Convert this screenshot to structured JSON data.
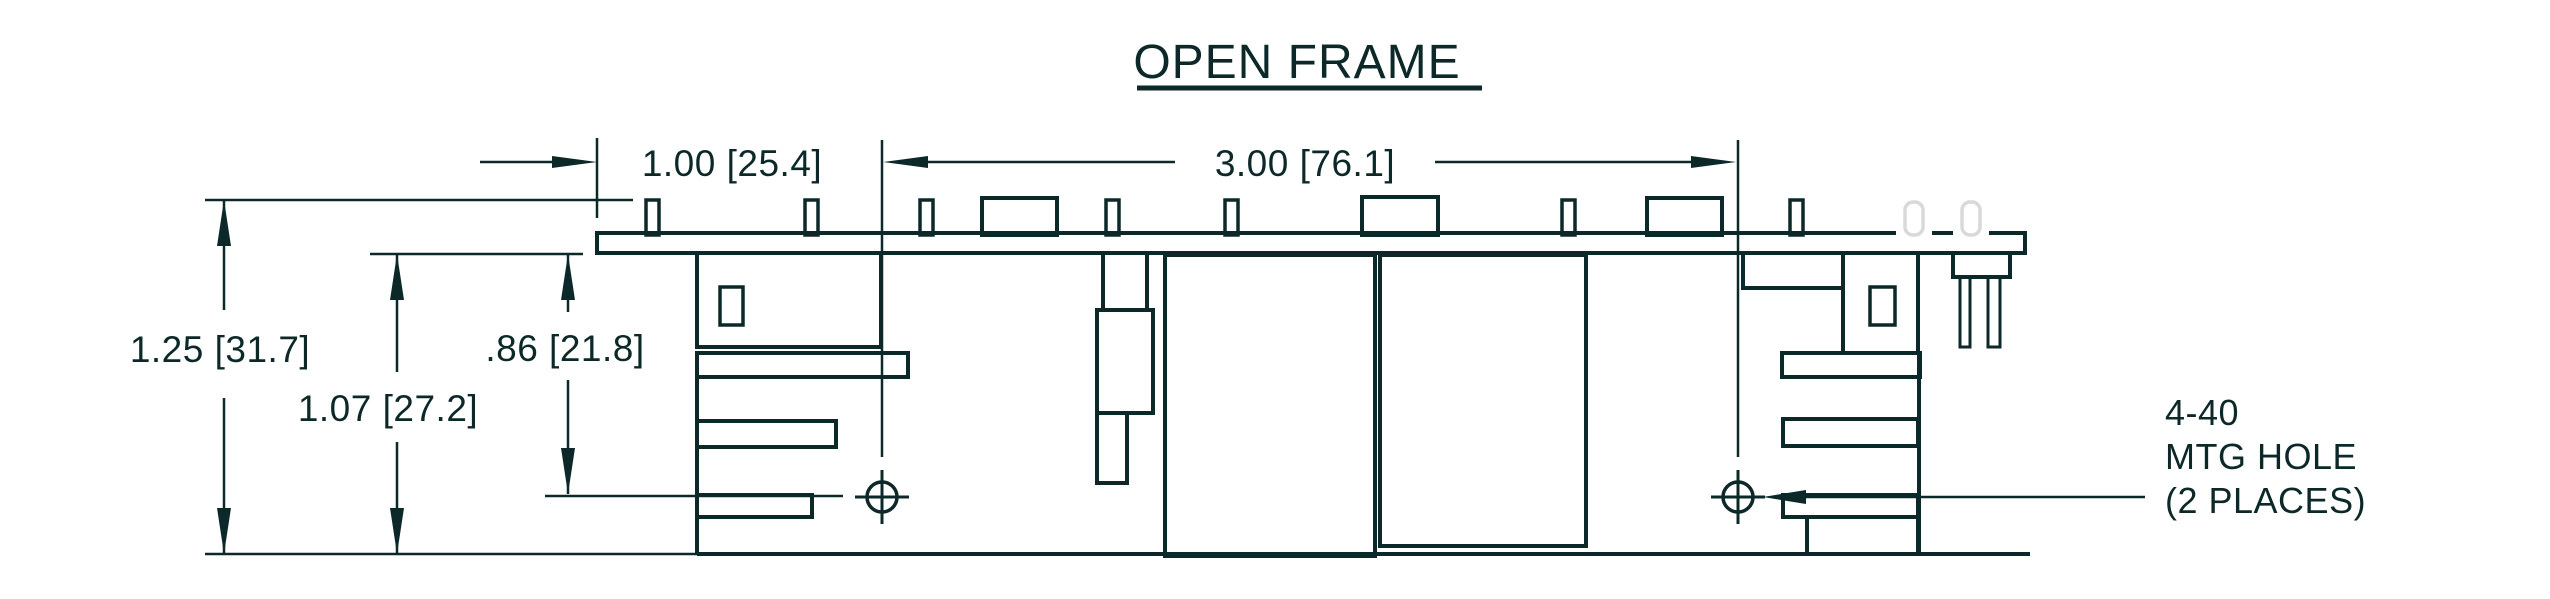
{
  "title": {
    "text": "OPEN FRAME"
  },
  "note": {
    "lines": [
      "4-40",
      "MTG HOLE",
      "(2 PLACES)"
    ]
  },
  "dimensions": {
    "horizontal": [
      {
        "label": "1.00 [25.4]"
      },
      {
        "label": "3.00 [76.1]"
      }
    ],
    "vertical": [
      {
        "label": "1.25 [31.7]"
      },
      {
        "label": "1.07 [27.2]"
      },
      {
        "label": ".86 [21.8]"
      }
    ]
  },
  "colors": {
    "stroke": "#0d2828",
    "phantom": "#d9d9d9",
    "background": "#ffffff"
  },
  "drawing": {
    "width": 2550,
    "height": 599,
    "rects": [
      {
        "name": "pcb-board",
        "x": 597,
        "y": 233,
        "w": 1428,
        "h": 20,
        "sw": 4
      },
      {
        "name": "pcb-pin",
        "x": 646,
        "y": 200,
        "w": 13,
        "h": 35,
        "sw": 3.5
      },
      {
        "name": "pcb-pin",
        "x": 805,
        "y": 200,
        "w": 13,
        "h": 35,
        "sw": 3.5
      },
      {
        "name": "pcb-pin",
        "x": 920,
        "y": 200,
        "w": 13,
        "h": 35,
        "sw": 3.5
      },
      {
        "name": "pcb-pin",
        "x": 1106,
        "y": 200,
        "w": 13,
        "h": 35,
        "sw": 3.5
      },
      {
        "name": "pcb-pin",
        "x": 1225,
        "y": 200,
        "w": 13,
        "h": 35,
        "sw": 3.5
      },
      {
        "name": "pcb-pin",
        "x": 1562,
        "y": 200,
        "w": 13,
        "h": 35,
        "sw": 3.5
      },
      {
        "name": "pcb-pin",
        "x": 1790,
        "y": 200,
        "w": 13,
        "h": 35,
        "sw": 3.5
      },
      {
        "name": "top-component",
        "x": 982,
        "y": 198,
        "w": 75,
        "h": 37,
        "sw": 4
      },
      {
        "name": "top-component",
        "x": 1362,
        "y": 197,
        "w": 76,
        "h": 38,
        "sw": 4
      },
      {
        "name": "top-component",
        "x": 1647,
        "y": 198,
        "w": 75,
        "h": 37,
        "sw": 4
      },
      {
        "name": "left-block",
        "x": 697,
        "y": 253,
        "w": 184,
        "h": 94,
        "sw": 4
      },
      {
        "name": "left-block-window",
        "x": 720,
        "y": 287,
        "w": 23,
        "h": 38,
        "sw": 3.5
      },
      {
        "name": "left-flange-bar",
        "x": 697,
        "y": 353,
        "w": 211,
        "h": 24,
        "sw": 4
      },
      {
        "name": "left-heatsink-fin",
        "x": 697,
        "y": 421,
        "w": 139,
        "h": 26,
        "sw": 4
      },
      {
        "name": "left-heatsink-fin",
        "x": 697,
        "y": 495,
        "w": 115,
        "h": 22,
        "sw": 4
      },
      {
        "name": "mid-component-body",
        "x": 1097,
        "y": 310,
        "w": 56,
        "h": 103,
        "sw": 4
      },
      {
        "name": "mid-component-leg",
        "x": 1097,
        "y": 413,
        "w": 30,
        "h": 70,
        "sw": 4
      },
      {
        "name": "transformer-block-1",
        "x": 1165,
        "y": 255,
        "w": 210,
        "h": 301,
        "sw": 4
      },
      {
        "name": "transformer-block-2",
        "x": 1380,
        "y": 255,
        "w": 206,
        "h": 291,
        "sw": 4
      },
      {
        "name": "right-notch-block",
        "x": 1743,
        "y": 253,
        "w": 100,
        "h": 35,
        "sw": 4
      },
      {
        "name": "right-block",
        "x": 1843,
        "y": 253,
        "w": 75,
        "h": 100,
        "sw": 4
      },
      {
        "name": "right-block-window",
        "x": 1870,
        "y": 287,
        "w": 25,
        "h": 38,
        "sw": 3.5
      },
      {
        "name": "right-heatsink-fin",
        "x": 1782,
        "y": 353,
        "w": 138,
        "h": 24,
        "sw": 4
      },
      {
        "name": "right-heatsink-fin",
        "x": 1783,
        "y": 419,
        "w": 135,
        "h": 27,
        "sw": 4
      },
      {
        "name": "right-heatsink-fin",
        "x": 1783,
        "y": 495,
        "w": 135,
        "h": 22,
        "sw": 4
      },
      {
        "name": "right-bottom-block",
        "x": 1807,
        "y": 517,
        "w": 111,
        "h": 37,
        "sw": 4
      },
      {
        "name": "right-connector",
        "x": 1953,
        "y": 253,
        "w": 57,
        "h": 24,
        "sw": 4
      },
      {
        "name": "connector-pin",
        "x": 1960,
        "y": 277,
        "w": 10,
        "h": 70,
        "sw": 3
      },
      {
        "name": "connector-pin",
        "x": 1988,
        "y": 277,
        "w": 12,
        "h": 70,
        "sw": 3
      },
      {
        "name": "pcb-top-gap",
        "x": 1896,
        "y": 229,
        "w": 36,
        "h": 8,
        "sw": 0,
        "fill": "#ffffff"
      },
      {
        "name": "pcb-top-gap",
        "x": 1953,
        "y": 229,
        "w": 36,
        "h": 8,
        "sw": 0,
        "fill": "#ffffff"
      },
      {
        "name": "phantom-pin",
        "x": 1905,
        "y": 202,
        "w": 18,
        "h": 33,
        "sw": 3.5,
        "rx": 8,
        "phantom": true
      },
      {
        "name": "phantom-pin",
        "x": 1962,
        "y": 202,
        "w": 18,
        "h": 33,
        "sw": 3.5,
        "rx": 8,
        "phantom": true
      }
    ],
    "lines": [
      {
        "name": "baseline-extension",
        "x1": 205,
        "y1": 554,
        "x2": 697,
        "y2": 554,
        "sw": 2.5
      },
      {
        "name": "unit-baseline",
        "x1": 697,
        "y1": 554,
        "x2": 2030,
        "y2": 554,
        "sw": 4
      },
      {
        "name": "left-spine",
        "x1": 697,
        "y1": 377,
        "x2": 697,
        "y2": 554,
        "sw": 4
      },
      {
        "name": "right-spine",
        "x1": 1919,
        "y1": 353,
        "x2": 1919,
        "y2": 554,
        "sw": 4
      },
      {
        "name": "mid-neck-left",
        "x1": 1103,
        "y1": 253,
        "x2": 1103,
        "y2": 310,
        "sw": 4
      },
      {
        "name": "mid-neck-right",
        "x1": 1147,
        "y1": 253,
        "x2": 1147,
        "y2": 310,
        "sw": 4
      },
      {
        "name": "centerline-left",
        "x1": 882,
        "y1": 140,
        "x2": 882,
        "y2": 457,
        "sw": 2.5
      },
      {
        "name": "centerline-right",
        "x1": 1738,
        "y1": 140,
        "x2": 1738,
        "y2": 457,
        "sw": 2.5
      },
      {
        "name": "hole-crosshair-v",
        "x1": 882,
        "y1": 470,
        "x2": 882,
        "y2": 524,
        "sw": 3
      },
      {
        "name": "hole-crosshair-h",
        "x1": 855,
        "y1": 497,
        "x2": 909,
        "y2": 497,
        "sw": 3
      },
      {
        "name": "hole-crosshair-v",
        "x1": 1738,
        "y1": 470,
        "x2": 1738,
        "y2": 524,
        "sw": 3
      },
      {
        "name": "hole-crosshair-h",
        "x1": 1711,
        "y1": 497,
        "x2": 1765,
        "y2": 497,
        "sw": 3
      },
      {
        "name": "extension-line-100",
        "x1": 597,
        "y1": 138,
        "x2": 597,
        "y2": 218,
        "sw": 2.5
      },
      {
        "name": "dim-100-arrow-shaft",
        "x1": 480,
        "y1": 162,
        "x2": 554,
        "y2": 162,
        "sw": 2.5
      },
      {
        "name": "dim-300-shaft-left",
        "x1": 926,
        "y1": 162,
        "x2": 1175,
        "y2": 162,
        "sw": 2.5
      },
      {
        "name": "dim-300-shaft-right",
        "x1": 1435,
        "y1": 162,
        "x2": 1693,
        "y2": 162,
        "sw": 2.5
      },
      {
        "name": "extension-line-top",
        "x1": 205,
        "y1": 200,
        "x2": 633,
        "y2": 200,
        "sw": 2.5
      },
      {
        "name": "dim-125-shaft-a",
        "x1": 224,
        "y1": 200,
        "x2": 224,
        "y2": 310,
        "sw": 2.5
      },
      {
        "name": "dim-125-shaft-b",
        "x1": 224,
        "y1": 398,
        "x2": 224,
        "y2": 554,
        "sw": 2.5
      },
      {
        "name": "extension-line-pcb-bottom",
        "x1": 370,
        "y1": 254,
        "x2": 583,
        "y2": 254,
        "sw": 2.5
      },
      {
        "name": "dim-107-shaft-a",
        "x1": 397,
        "y1": 254,
        "x2": 397,
        "y2": 372,
        "sw": 2.5
      },
      {
        "name": "dim-107-shaft-b",
        "x1": 397,
        "y1": 442,
        "x2": 397,
        "y2": 554,
        "sw": 2.5
      },
      {
        "name": "dim-86-shaft-a",
        "x1": 568,
        "y1": 254,
        "x2": 568,
        "y2": 312,
        "sw": 2.5
      },
      {
        "name": "dim-86-shaft-b",
        "x1": 568,
        "y1": 380,
        "x2": 568,
        "y2": 494,
        "sw": 2.5
      },
      {
        "name": "leader-86-to-hole",
        "x1": 545,
        "y1": 496,
        "x2": 843,
        "y2": 496,
        "sw": 2.5
      },
      {
        "name": "leader-mtg-hole",
        "x1": 1806,
        "y1": 497,
        "x2": 2145,
        "y2": 497,
        "sw": 2.5
      },
      {
        "name": "title-underline",
        "x1": 1137,
        "y1": 88,
        "x2": 1482,
        "y2": 88,
        "sw": 5
      }
    ],
    "polygons": [
      {
        "name": "arrowhead-100-right",
        "points": "597,162 552,156 552,168"
      },
      {
        "name": "arrowhead-300-left",
        "points": "883,162 928,156 928,168"
      },
      {
        "name": "arrowhead-300-right",
        "points": "1736,162 1691,156 1691,168"
      },
      {
        "name": "arrowhead-125-up",
        "points": "224,200 217,246 231,246"
      },
      {
        "name": "arrowhead-125-down",
        "points": "224,554 217,508 231,508"
      },
      {
        "name": "arrowhead-107-up",
        "points": "397,254 390,300 404,300"
      },
      {
        "name": "arrowhead-107-down",
        "points": "397,554 390,508 404,508"
      },
      {
        "name": "arrowhead-86-up",
        "points": "568,254 561,300 575,300"
      },
      {
        "name": "arrowhead-86-down",
        "points": "568,494 561,448 575,448"
      },
      {
        "name": "arrowhead-mtg-leader-left",
        "points": "1763,497 1806,490 1806,504"
      }
    ],
    "circles": [
      {
        "name": "mounting-hole-left",
        "cx": 882,
        "cy": 497,
        "r": 15,
        "sw": 3.5
      },
      {
        "name": "mounting-hole-right",
        "cx": 1738,
        "cy": 497,
        "r": 15,
        "sw": 3.5
      }
    ],
    "texts": [
      {
        "name": "drawing-title",
        "x": 1297,
        "y": 78,
        "size": 48,
        "anchor": "middle",
        "text": "OPEN FRAME",
        "spacing": 1
      },
      {
        "name": "dim-label-100",
        "x": 732,
        "y": 176,
        "size": 37,
        "anchor": "middle",
        "text": "1.00 [25.4]"
      },
      {
        "name": "dim-label-300",
        "x": 1305,
        "y": 176,
        "size": 37,
        "anchor": "middle",
        "text": "3.00 [76.1]"
      },
      {
        "name": "dim-label-125",
        "x": 220,
        "y": 362,
        "size": 37,
        "anchor": "middle",
        "text": "1.25 [31.7]"
      },
      {
        "name": "dim-label-107",
        "x": 388,
        "y": 421,
        "size": 37,
        "anchor": "middle",
        "text": "1.07 [27.2]"
      },
      {
        "name": "dim-label-86",
        "x": 565,
        "y": 361,
        "size": 37,
        "anchor": "middle",
        "text": ".86 [21.8]"
      },
      {
        "name": "note-line-1",
        "x": 2165,
        "y": 425,
        "size": 36,
        "anchor": "start",
        "text": "4-40"
      },
      {
        "name": "note-line-2",
        "x": 2165,
        "y": 469,
        "size": 36,
        "anchor": "start",
        "text": "MTG HOLE"
      },
      {
        "name": "note-line-3",
        "x": 2165,
        "y": 513,
        "size": 36,
        "anchor": "start",
        "text": "(2 PLACES)"
      }
    ]
  }
}
